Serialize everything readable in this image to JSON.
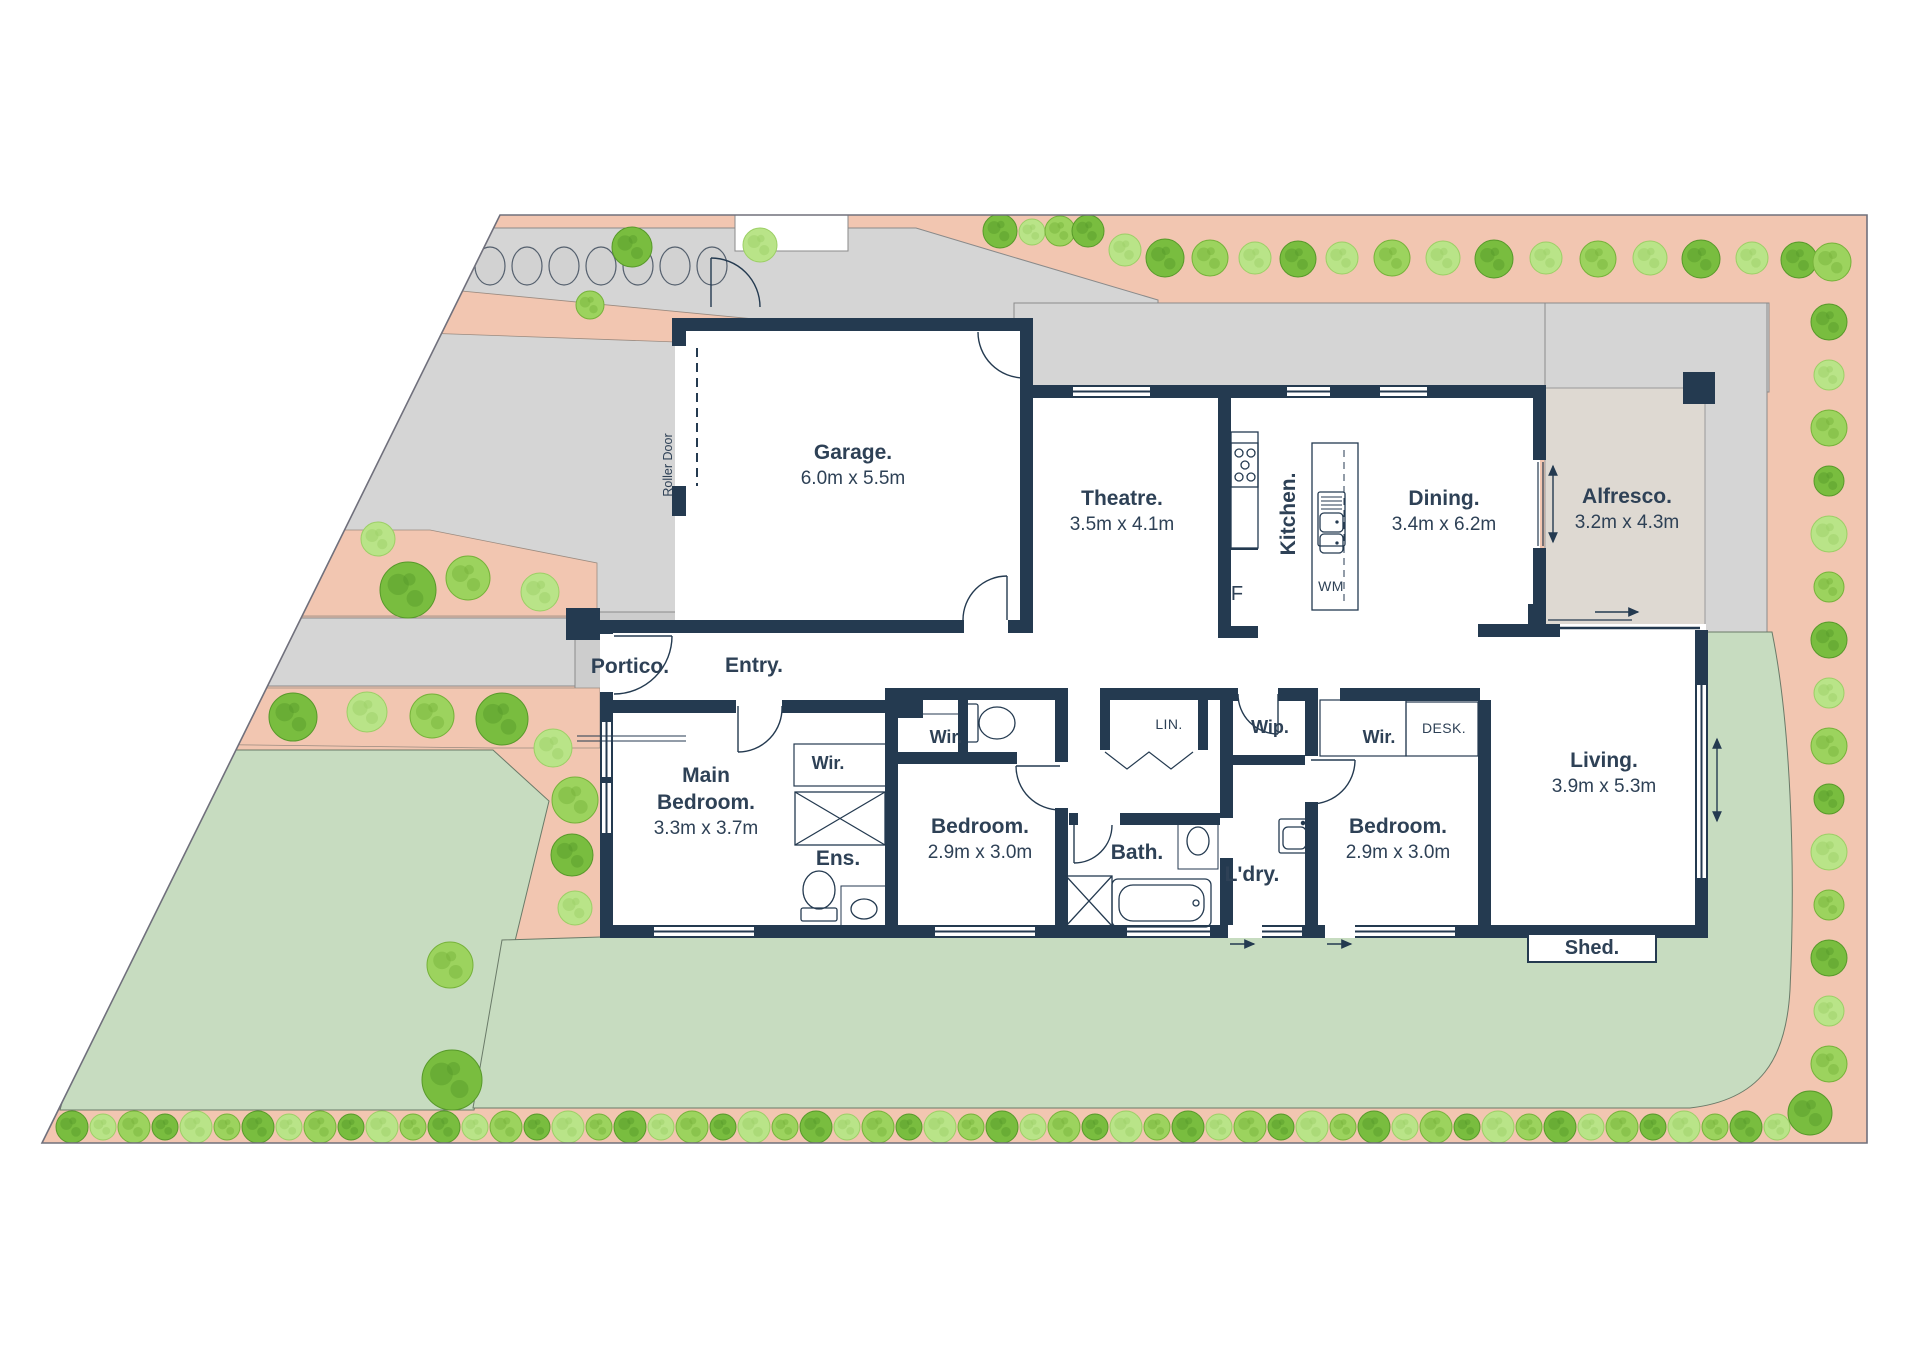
{
  "rooms": {
    "garage": {
      "name": "Garage.",
      "dims": "6.0m x 5.5m"
    },
    "theatre": {
      "name": "Theatre.",
      "dims": "3.5m x 4.1m"
    },
    "kitchen": {
      "name": "Kitchen."
    },
    "dining": {
      "name": "Dining.",
      "dims": "3.4m x 6.2m"
    },
    "alfresco": {
      "name": "Alfresco.",
      "dims": "3.2m x 4.3m"
    },
    "portico": {
      "name": "Portico."
    },
    "entry": {
      "name": "Entry."
    },
    "main_bedroom": {
      "l1": "Main",
      "l2": "Bedroom.",
      "dims": "3.3m x 3.7m"
    },
    "wir_main": {
      "name": "Wir."
    },
    "ens": {
      "name": "Ens."
    },
    "wir_bed2": {
      "name": "Wir."
    },
    "bedroom2": {
      "name": "Bedroom.",
      "dims": "2.9m x 3.0m"
    },
    "bath": {
      "name": "Bath."
    },
    "ldry": {
      "name": "L'dry."
    },
    "lin": {
      "name": "LIN."
    },
    "wip": {
      "name": "Wip."
    },
    "wir_bed3": {
      "name": "Wir."
    },
    "desk": {
      "name": "DESK."
    },
    "bedroom3": {
      "name": "Bedroom.",
      "dims": "2.9m x 3.0m"
    },
    "living": {
      "name": "Living.",
      "dims": "3.9m x 5.3m"
    },
    "shed": {
      "name": "Shed."
    },
    "roller_door": {
      "name": "Roller Door"
    },
    "wm": {
      "name": "WM"
    },
    "fridge": {
      "name": "F"
    }
  },
  "colors": {
    "wall": "#243a50",
    "text": "#2e4156",
    "path_pink": "#f2c6b1",
    "lawn_green": "#c7dcc0",
    "driveway_gray": "#d5d5d5",
    "portico_gray": "#cdcdcd",
    "alfresco_floor": "#ded9d2",
    "boundary": "#70707c",
    "tree_variants": [
      {
        "fill": "#79bd3f",
        "spot": "#57992a"
      },
      {
        "fill": "#b9e488",
        "spot": "#9ccf66"
      },
      {
        "fill": "#9cd35e",
        "spot": "#76b23a"
      }
    ]
  },
  "landscape": {
    "stones": {
      "cy": 266,
      "rx": 15,
      "ry": 19,
      "xs": [
        490,
        527,
        564,
        601,
        638,
        675,
        712
      ]
    },
    "trees": {
      "top_row": [
        [
          632,
          247,
          20,
          0
        ],
        [
          760,
          245,
          17,
          1
        ],
        [
          1000,
          231,
          17,
          0
        ],
        [
          1032,
          232,
          13,
          1
        ],
        [
          1060,
          231,
          15,
          2
        ],
        [
          1088,
          231,
          16,
          0
        ],
        [
          1125,
          250,
          16,
          1
        ],
        [
          1165,
          258,
          19,
          0
        ],
        [
          1210,
          258,
          18,
          2
        ],
        [
          1255,
          258,
          16,
          1
        ],
        [
          1298,
          259,
          18,
          0
        ],
        [
          1342,
          258,
          16,
          1
        ],
        [
          1392,
          258,
          18,
          2
        ],
        [
          1443,
          258,
          17,
          1
        ],
        [
          1494,
          259,
          19,
          0
        ],
        [
          1546,
          258,
          16,
          1
        ],
        [
          1598,
          259,
          18,
          2
        ],
        [
          1650,
          258,
          17,
          1
        ],
        [
          1701,
          259,
          19,
          0
        ],
        [
          1752,
          258,
          16,
          1
        ],
        [
          1799,
          260,
          18,
          0
        ],
        [
          1832,
          262,
          19,
          2
        ]
      ],
      "right_col": {
        "x": 1829,
        "y_start": 322,
        "spacing": 53,
        "count": 15
      },
      "bottom_row": {
        "y": 1127,
        "x_start": 72,
        "x_end": 1792,
        "spacing": 31
      },
      "misc": [
        [
          378,
          539,
          17,
          1
        ],
        [
          408,
          590,
          28,
          0
        ],
        [
          468,
          578,
          22,
          2
        ],
        [
          540,
          592,
          19,
          1
        ],
        [
          590,
          305,
          14,
          2
        ],
        [
          293,
          717,
          24,
          0
        ],
        [
          367,
          712,
          20,
          1
        ],
        [
          432,
          716,
          22,
          2
        ],
        [
          502,
          719,
          26,
          0
        ],
        [
          553,
          748,
          19,
          1
        ],
        [
          575,
          800,
          23,
          2
        ],
        [
          572,
          855,
          21,
          0
        ],
        [
          575,
          908,
          17,
          1
        ],
        [
          450,
          965,
          23,
          2
        ],
        [
          452,
          1080,
          30,
          0
        ],
        [
          1810,
          1113,
          22,
          0
        ]
      ]
    }
  }
}
